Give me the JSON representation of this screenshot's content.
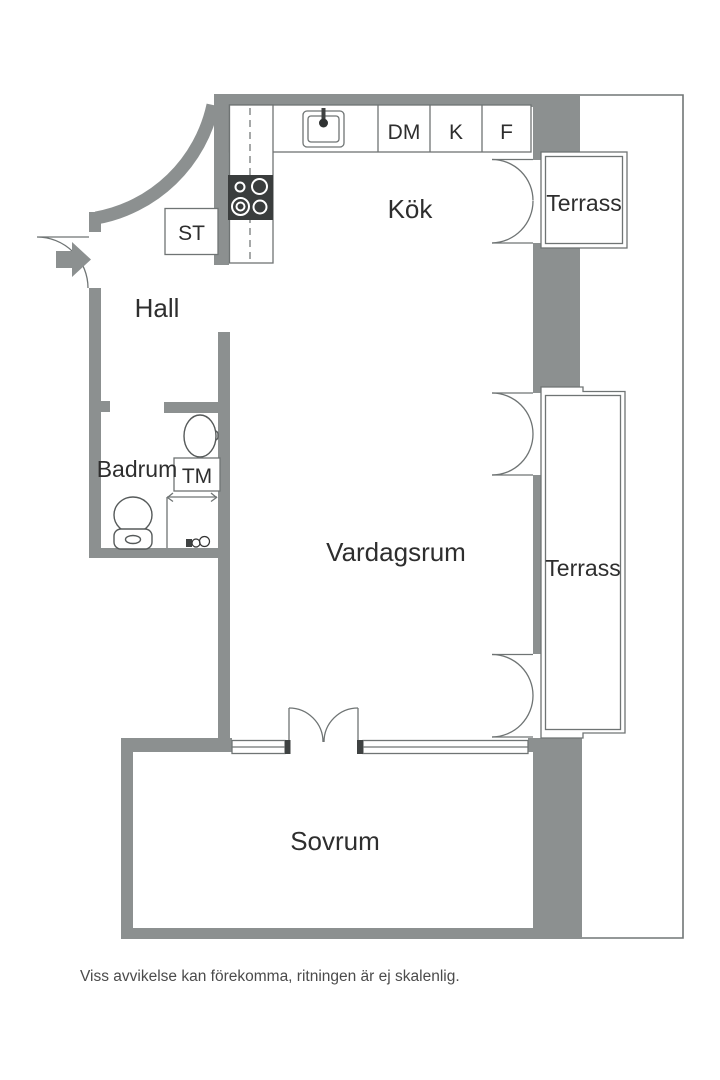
{
  "labels": {
    "hall": "Hall",
    "kitchen": "Kök",
    "bathroom": "Badrum",
    "living_room": "Vardagsrum",
    "bedroom": "Sovrum",
    "terrace_top": "Terrass",
    "terrace_right": "Terrass",
    "closet": "ST",
    "washing_machine": "TM",
    "dishwasher": "DM",
    "fridge": "K",
    "freezer": "F"
  },
  "footer": {
    "disclaimer": "Viss avvikelse kan förekomma, ritningen är ej skalenlig."
  },
  "colors": {
    "wall": "#8c9090",
    "outline": "#6f7474",
    "text": "#2e2e2e",
    "stove": "#3a3d3d",
    "background": "#ffffff"
  }
}
